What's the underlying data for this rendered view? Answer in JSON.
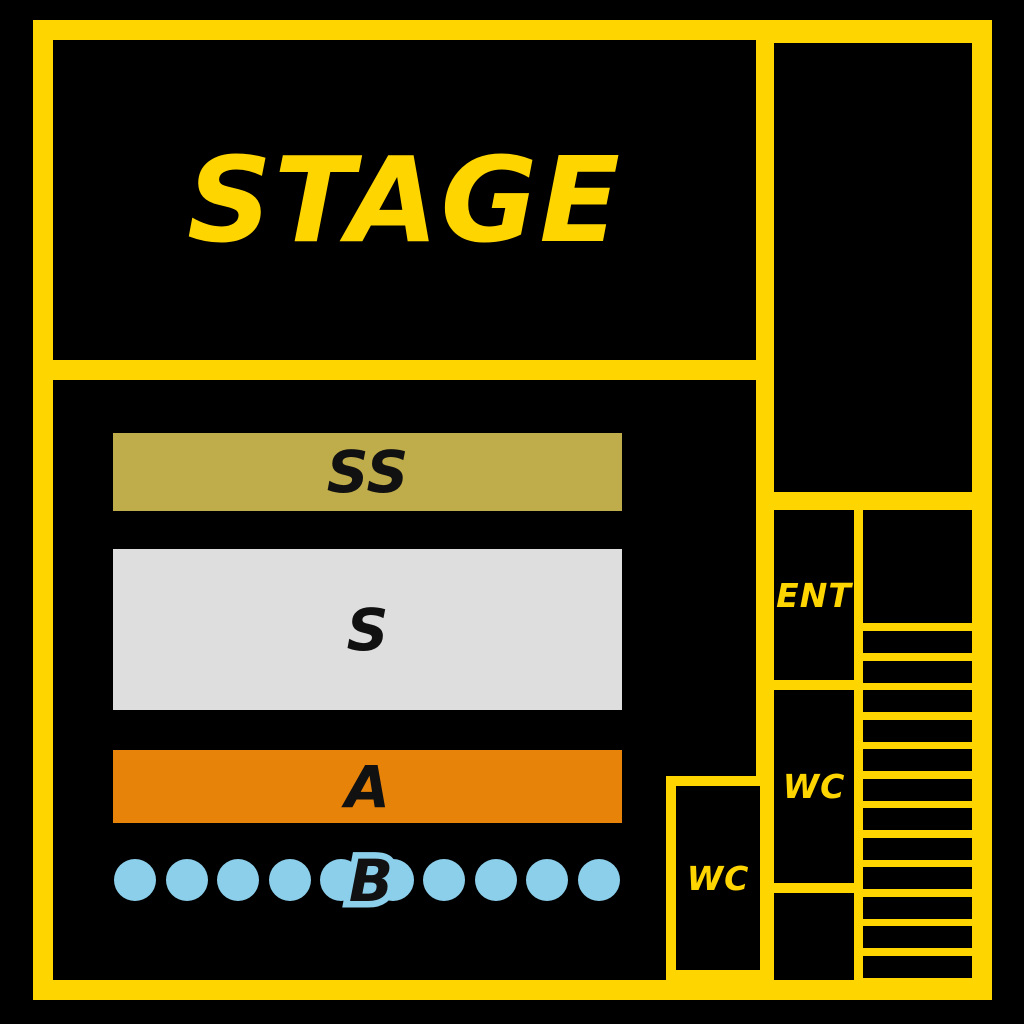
{
  "map": {
    "stage": {
      "label": "STAGE"
    },
    "sections": [
      {
        "id": "ss",
        "label": "SS",
        "color": "#BFAC4B"
      },
      {
        "id": "s",
        "label": "S",
        "color": "#DEDEDE"
      },
      {
        "id": "a",
        "label": "A",
        "color": "#E8830A"
      },
      {
        "id": "b",
        "label": "B",
        "seat_count": 10,
        "seat_color": "#8CCFEB"
      }
    ],
    "rooms": {
      "entrance": "ENT",
      "wc_right": "WC",
      "wc_left": "WC"
    },
    "stairs": {
      "steps": 12
    },
    "colors": {
      "background": "#000000",
      "walls": "#FFD500",
      "label_on_section": "#111111"
    }
  }
}
